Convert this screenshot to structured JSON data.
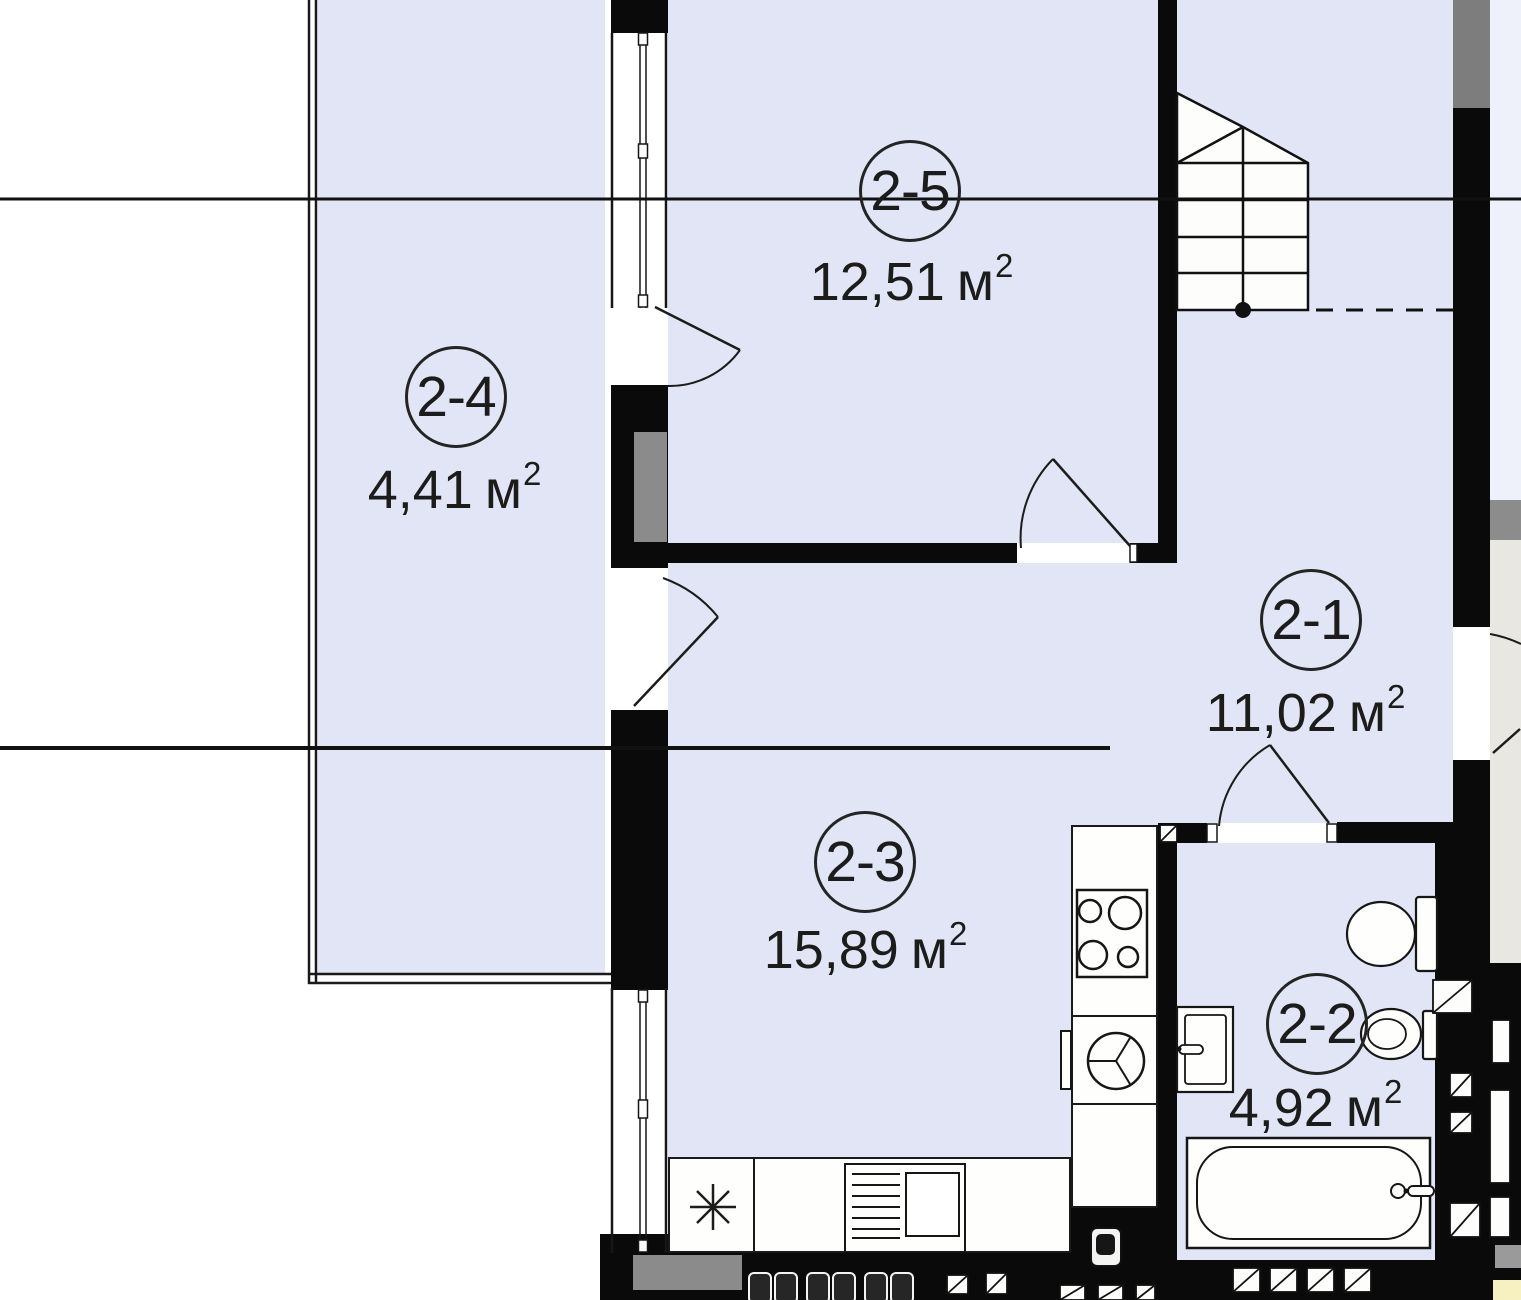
{
  "plan": {
    "kind": "apartment-floor-plan",
    "language": "uk/ru",
    "rooms_total": 5
  },
  "rooms": [
    {
      "id": "2-1",
      "area": "11,02",
      "unit": "м",
      "sup": "2"
    },
    {
      "id": "2-2",
      "area": "4,92",
      "unit": "м",
      "sup": "2"
    },
    {
      "id": "2-3",
      "area": "15,89",
      "unit": "м",
      "sup": "2"
    },
    {
      "id": "2-4",
      "area": "4,41",
      "unit": "м",
      "sup": "2"
    },
    {
      "id": "2-5",
      "area": "12,51",
      "unit": "м",
      "sup": "2"
    }
  ],
  "colors": {
    "floor_fill": "#e2e5f5",
    "wall": "#0a0a0a",
    "shaft_gray": "#8b8b8b",
    "outside": "#ffffff",
    "corridor_gray": "#e8e7e2",
    "pale_blue": "#eef1fa",
    "corner_yellow": "#f7f1c2",
    "line": "#1a1a1a"
  },
  "icons": [
    "stairs-icon",
    "stove-icon",
    "kitchen-sink-icon",
    "dishwasher-icon",
    "asterisk-icon",
    "toilet-icon",
    "bidet-icon",
    "washbasin-icon",
    "bathtub-icon",
    "boiler-icon",
    "door-swing-icon",
    "window-icon",
    "vent-shaft-icon"
  ]
}
